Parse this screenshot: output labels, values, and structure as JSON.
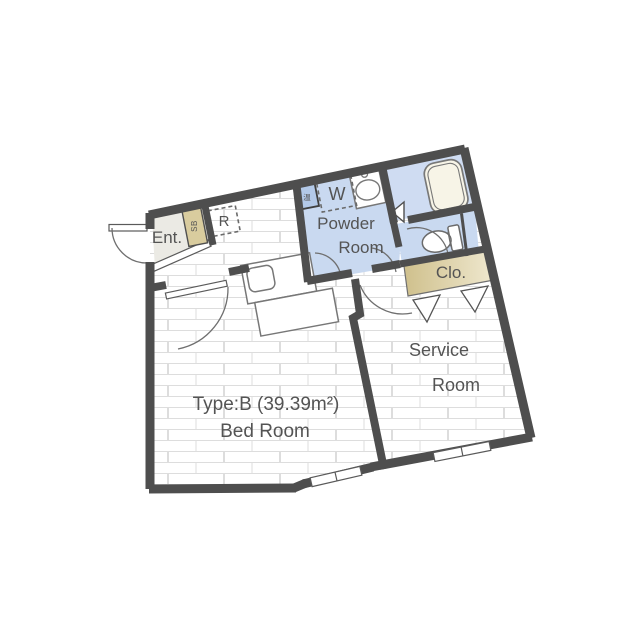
{
  "floorplan": {
    "labels": {
      "entrance": "Ent.",
      "shoe_box": "SB",
      "refrigerator": "R",
      "washer": "W",
      "water_heater": "温",
      "powder_room_line1": "Powder",
      "powder_room_line2": "Room",
      "closet": "Clo.",
      "service_room_line1": "Service",
      "service_room_line2": "Room",
      "bedroom_type": "Type:B (39.39m²)",
      "bedroom": "Bed Room"
    },
    "icons": [
      "bathtub-icon",
      "toilet-icon",
      "washbasin-icon",
      "kitchen-sink-icon",
      "door-swing-arc-icon",
      "folding-door-triangle-icon",
      "window-icon",
      "water-heater-icon"
    ],
    "colors": {
      "wall": "#4e4e4e",
      "wet_area_floor": "#c9d9f0",
      "water_heater_fill": "#b3c9e8",
      "washer_box_fill": "#dce5f4",
      "closet_dark": "#cfc08c",
      "closet_light": "#efe8cf",
      "entrance_floor": "#ebeae4",
      "wood_floor_line": "#dddddd",
      "fixture_outline": "#777777",
      "text": "#545454",
      "background": "#ffffff"
    }
  }
}
